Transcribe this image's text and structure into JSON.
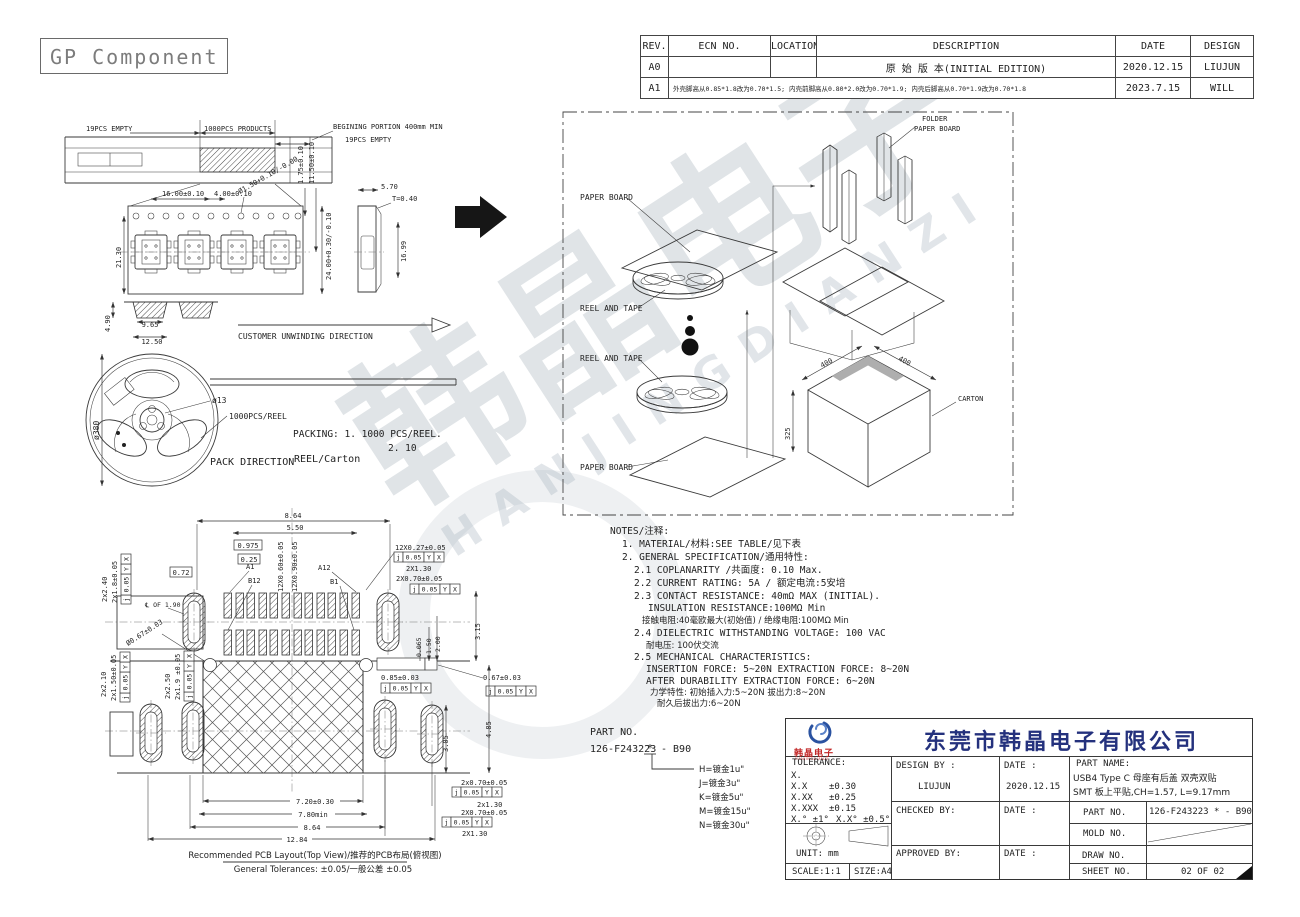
{
  "sheet": {
    "title": "GP Component"
  },
  "revision": {
    "headers": [
      "REV.",
      "ECN NO.",
      "LOCATIONS",
      "DESCRIPTION",
      "DATE",
      "DESIGN"
    ],
    "rows": [
      {
        "rev": "A0",
        "ecn": "",
        "locations": "",
        "description": "原 始 版 本(INITIAL EDITION)",
        "date": "2020.12.15",
        "design": "LIUJUN"
      },
      {
        "rev": "A1",
        "description": "外壳脚高从0.85*1.8改为0.70*1.5; 内壳前脚高从0.80*2.0改为0.70*1.9; 内壳后脚高从0.70*1.9改为0.70*1.8",
        "date": "2023.7.15",
        "design": "WILL"
      }
    ]
  },
  "tape": {
    "empty_left": "19PCS EMPTY",
    "products": "1000PCS PRODUCTS",
    "begining": "BEGINING PORTION 400mm MIN",
    "empty_right": "19PCS EMPTY",
    "span": "16.00±0.10",
    "pitch": "4.00±0.10",
    "hole": "Ø1.50+0.10/-0.00",
    "edge": "1.75±0.10",
    "center": "11.50±0.10",
    "width": "21.30",
    "reel_w": "24.00+0.30/-0.10",
    "side_w": "5.70",
    "thick": "T=0.40",
    "side_h": "16.99",
    "pocket_w": "9.65",
    "pocket_ow": "12.50",
    "pocket_d": "4.90",
    "unwind": "CUSTOMER UNWINDING DIRECTION"
  },
  "reel": {
    "dia": "ø380",
    "hub": "ø13",
    "qty": "1000PCS/REEL",
    "packing_1": "PACKING: 1. 1000 PCS/REEL.",
    "packing_2": "2. 10",
    "pack_dir": "PACK DIRECTION",
    "pack_mode": "REEL/Carton"
  },
  "packing": {
    "paper_board": "PAPER BOARD",
    "reel_and_tape": "REEL AND TAPE",
    "folder_1": "FOLDER",
    "folder_2": "PAPER BOARD",
    "carton": "CARTON",
    "w": "400",
    "d": "400",
    "h": "325"
  },
  "notes": {
    "lines": [
      "NOTES/注释:",
      "1.  MATERIAL/材料:SEE TABLE/见下表",
      "2.  GENERAL SPECIFICATION/通用特性:",
      "2.1 COPLANARITY /共面度: 0.10 Max.",
      "2.2 CURRENT RATING: 5A / 额定电流:5安培",
      "2.3 CONTACT RESISTANCE: 40mΩ MAX (INITIAL).",
      "INSULATION RESISTANCE:100MΩ Min",
      "接触电阻:40毫欧最大(初始值) / 绝缘电阻:100MΩ Min",
      "2.4 DIELECTRIC WITHSTANDING VOLTAGE: 100 VAC",
      "耐电压: 100伏交流",
      "2.5 MECHANICAL CHARACTERISTICS:",
      "INSERTION FORCE: 5~20N EXTRACTION FORCE: 8~20N",
      "AFTER DURABILITY EXTRACTION FORCE: 6~20N",
      "力学特性: 初始插入力:5~20N 拔出力:8~20N",
      "耐久后拔出力:6~20N"
    ]
  },
  "pcb": {
    "fcf": {
      "sym": "j",
      "tol": "0.05",
      "a": "Y",
      "b": "X"
    },
    "d864": "8.64",
    "d550": "5.50",
    "d0975": "0.975",
    "d025": "0.25",
    "d072": "0.72",
    "d12x060": "12X0.60±0.05",
    "d12x090": "12X0.90±0.05",
    "a1": "A1",
    "b12": "B12",
    "a12": "A12",
    "b1": "B1",
    "d12x027": "12X0.27±0.05",
    "d2x130": "2X1.30",
    "d2x070": "2X0.70±0.05",
    "d2x240": "2x2.40",
    "d2x18": "2x1.8±0.05",
    "cl": "℄ OF 1.90",
    "dhole": "Ø0.67±0.03",
    "d0065": "0.065",
    "d150": "1.50",
    "d200": "2.00",
    "d315": "3.15",
    "d085": "0.85±0.03",
    "d067": "0.67±0.03",
    "d2x210": "2x2.10",
    "d2x150": "2x1.50±0.05",
    "d2x250": "2x2.50",
    "d2x19": "2x1.9 ±0.05",
    "d305": "3.05",
    "d485": "4.85",
    "d720": "7.20±0.30",
    "d780": "7.80min",
    "d864b": "8.64",
    "d1284": "12.84",
    "d2x070a": "2x0.70±0.05",
    "d2x130a": "2x1.30",
    "d2x070b": "2X0.70±0.05",
    "d2x130b": "2X1.30",
    "caption": "Recommended PCB Layout(Top View)/推荐的PCB布局(俯视图)",
    "tolerances": "General Tolerances: ±0.05/一般公差 ±0.05"
  },
  "part": {
    "label": "PART NO.",
    "base": "126-F243223",
    "star": "*",
    "suffix": "- B90",
    "opt1": "H=镀金1u\"",
    "opt2": "J=镀金3u\"",
    "opt3": "K=镀金5u\"",
    "opt4": "M=镀金15u\"",
    "opt5": "N=镀金30u\""
  },
  "tb": {
    "company": "东莞市韩晶电子有限公司",
    "logo_cn": "韩晶电子",
    "logo_en": "HANJINGDIANZI",
    "tolerance": "TOLERANCE:",
    "t_x": "X.",
    "t_x1": "X.X",
    "t_v1": "±0.30",
    "t_x2": "X.XX",
    "t_v2": "±0.25",
    "t_x3": "X.XXX",
    "t_v3": "±0.15",
    "t_ang": "X.° ±1°",
    "t_ang2": "X.X° ±0.5°",
    "unit_label": "UNIT:",
    "unit": "mm",
    "scale": "SCALE:1:1",
    "size": "SIZE:A4",
    "design_by": "DESIGN BY :",
    "designer": "LIUJUN",
    "date1_label": "DATE :",
    "date1": "2020.12.15",
    "checked_by": "CHECKED BY:",
    "date2_label": "DATE :",
    "approved_by": "APPROVED BY:",
    "date3_label": "DATE :",
    "part_name_label": "PART NAME:",
    "part_name_1": "USB4 Type C  母座有后盖 双壳双贴",
    "part_name_2": "SMT 板上平贴,CH=1.57, L=9.17mm",
    "part_no_label": "PART NO.",
    "part_no": "126-F243223  *  - B90",
    "mold_label": "MOLD NO.",
    "draw_label": "DRAW NO.",
    "sheet_label": "SHEET NO.",
    "sheet_no": "02 OF 02"
  },
  "watermark": {
    "cn": "韩晶电子",
    "en": "HANJINGDIANZI"
  }
}
